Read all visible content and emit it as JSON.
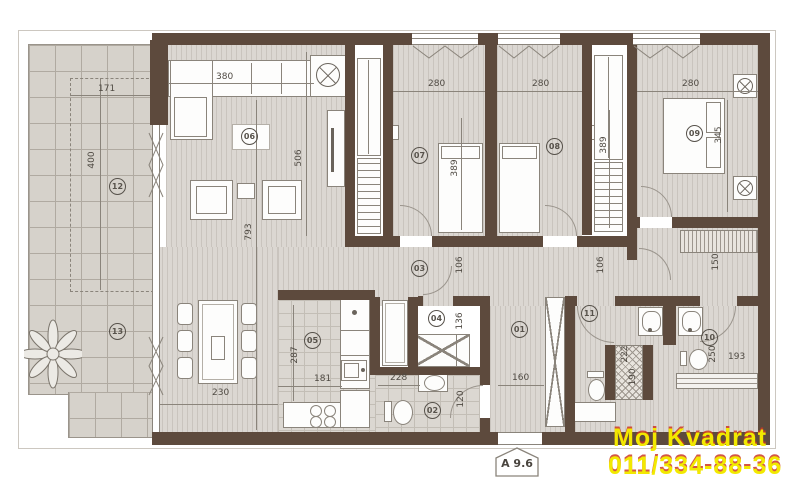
{
  "plan_title": "apartment-floor-plan",
  "badge": {
    "label": "A 9.6"
  },
  "watermark": {
    "line1": "Moj Kvadrat",
    "line2": "011/334-88-36",
    "text_color": "#f2e900",
    "shadow_color": "#cc3826"
  },
  "rooms": {
    "r1": "01",
    "r2": "02",
    "r3": "03",
    "r4": "04",
    "r5": "05",
    "r6": "06",
    "r7": "07",
    "r8": "08",
    "r9": "09",
    "r10": "10",
    "r11": "11",
    "r12": "12",
    "r13": "13"
  },
  "dims": {
    "d171": "171",
    "d400": "400",
    "d380": "380",
    "d280a": "280",
    "d280b": "280",
    "d280c": "280",
    "d506": "506",
    "d793": "793",
    "d389a": "389",
    "d389b": "389",
    "d345": "345",
    "d106a": "106",
    "d106b": "106",
    "d150": "150",
    "d136": "136",
    "d287": "287",
    "d181": "181",
    "d228": "228",
    "d120": "120",
    "d160": "160",
    "d222": "222",
    "d190": "190",
    "d250": "250",
    "d193": "193",
    "d230": "230"
  },
  "colors": {
    "wall": "#5d4a3d",
    "floor": "#dbd7d2",
    "terrace": "#d6d2cb"
  }
}
